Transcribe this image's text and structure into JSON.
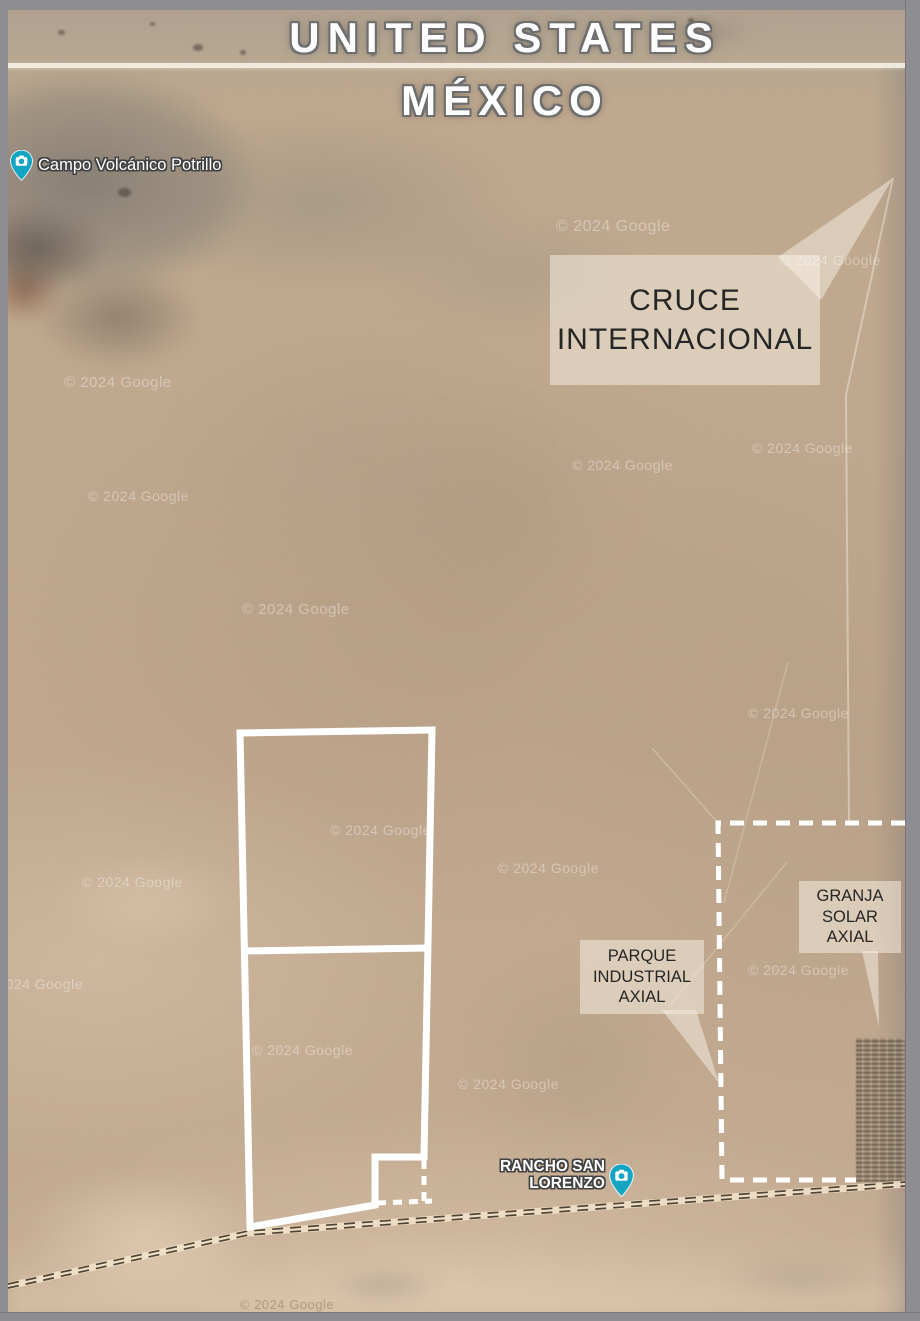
{
  "titles": {
    "united_states": "UNITED STATES",
    "mexico": "MÉXICO"
  },
  "pois": {
    "campo": {
      "label": "Campo Volcánico Potrillo"
    },
    "rancho": {
      "line1": "RANCHO SAN",
      "line2": "LORENZO"
    }
  },
  "callouts": {
    "cruce": {
      "line1": "CRUCE",
      "line2": "INTERNACIONAL"
    },
    "parque": {
      "line1": "PARQUE",
      "line2": "INDUSTRIAL",
      "line3": "AXIAL"
    },
    "granja": {
      "line1": "GRANJA",
      "line2": "SOLAR",
      "line3": "AXIAL"
    }
  },
  "watermark": {
    "text": "© 2024 Google"
  },
  "colors": {
    "pin_teal": "#14a5c2",
    "boundary_white": "#ffffff",
    "callout_fill": "#f7efe5",
    "desert_base": "#c0a78d",
    "frame_gray": "#8d8d92",
    "road_dark": "#4f4433",
    "label_text": "#262626"
  }
}
